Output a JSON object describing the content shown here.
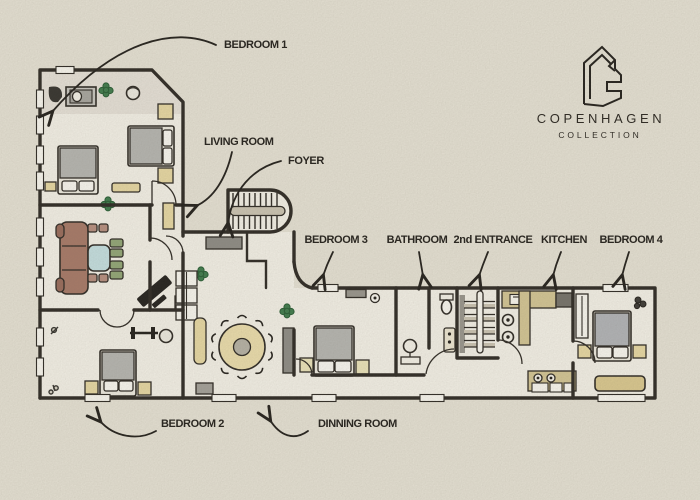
{
  "canvas": {
    "width": 700,
    "height": 500,
    "background": "#e8e4d6"
  },
  "brand": {
    "name": "COPENHAGEN",
    "tagline": "COLLECTION"
  },
  "labels": {
    "bedroom1": "BEDROOM 1",
    "livingRoom": "LIVING ROOM",
    "foyer": "FOYER",
    "bedroom3": "BEDROOM 3",
    "bathroom": "BATHROOM",
    "entrance2": "2nd ENTRANCE",
    "kitchen": "KITCHEN",
    "bedroom4": "BEDROOM 4",
    "bedroom2": "BEDROOM 2",
    "diningRoom": "DINNING ROOM"
  },
  "palette": {
    "ink": "#23201b",
    "wall": "#2e2a24",
    "floor": "#f6f3e9",
    "paper": "#e8e4d6",
    "wood": "#e9daa4",
    "counter": "#d5c795",
    "bedGray": "#b7b7b2",
    "pillow": "#fbf9f2",
    "sofaBrown": "#a87a68",
    "tableBlue": "#c6e1e2",
    "plantGreen": "#3f7c4c",
    "chairGreen": "#93a877",
    "chairPink": "#b89080",
    "cabinetGray": "#908e87",
    "stairTread": "#cdc6b4",
    "diningTable": "#eddfad"
  }
}
